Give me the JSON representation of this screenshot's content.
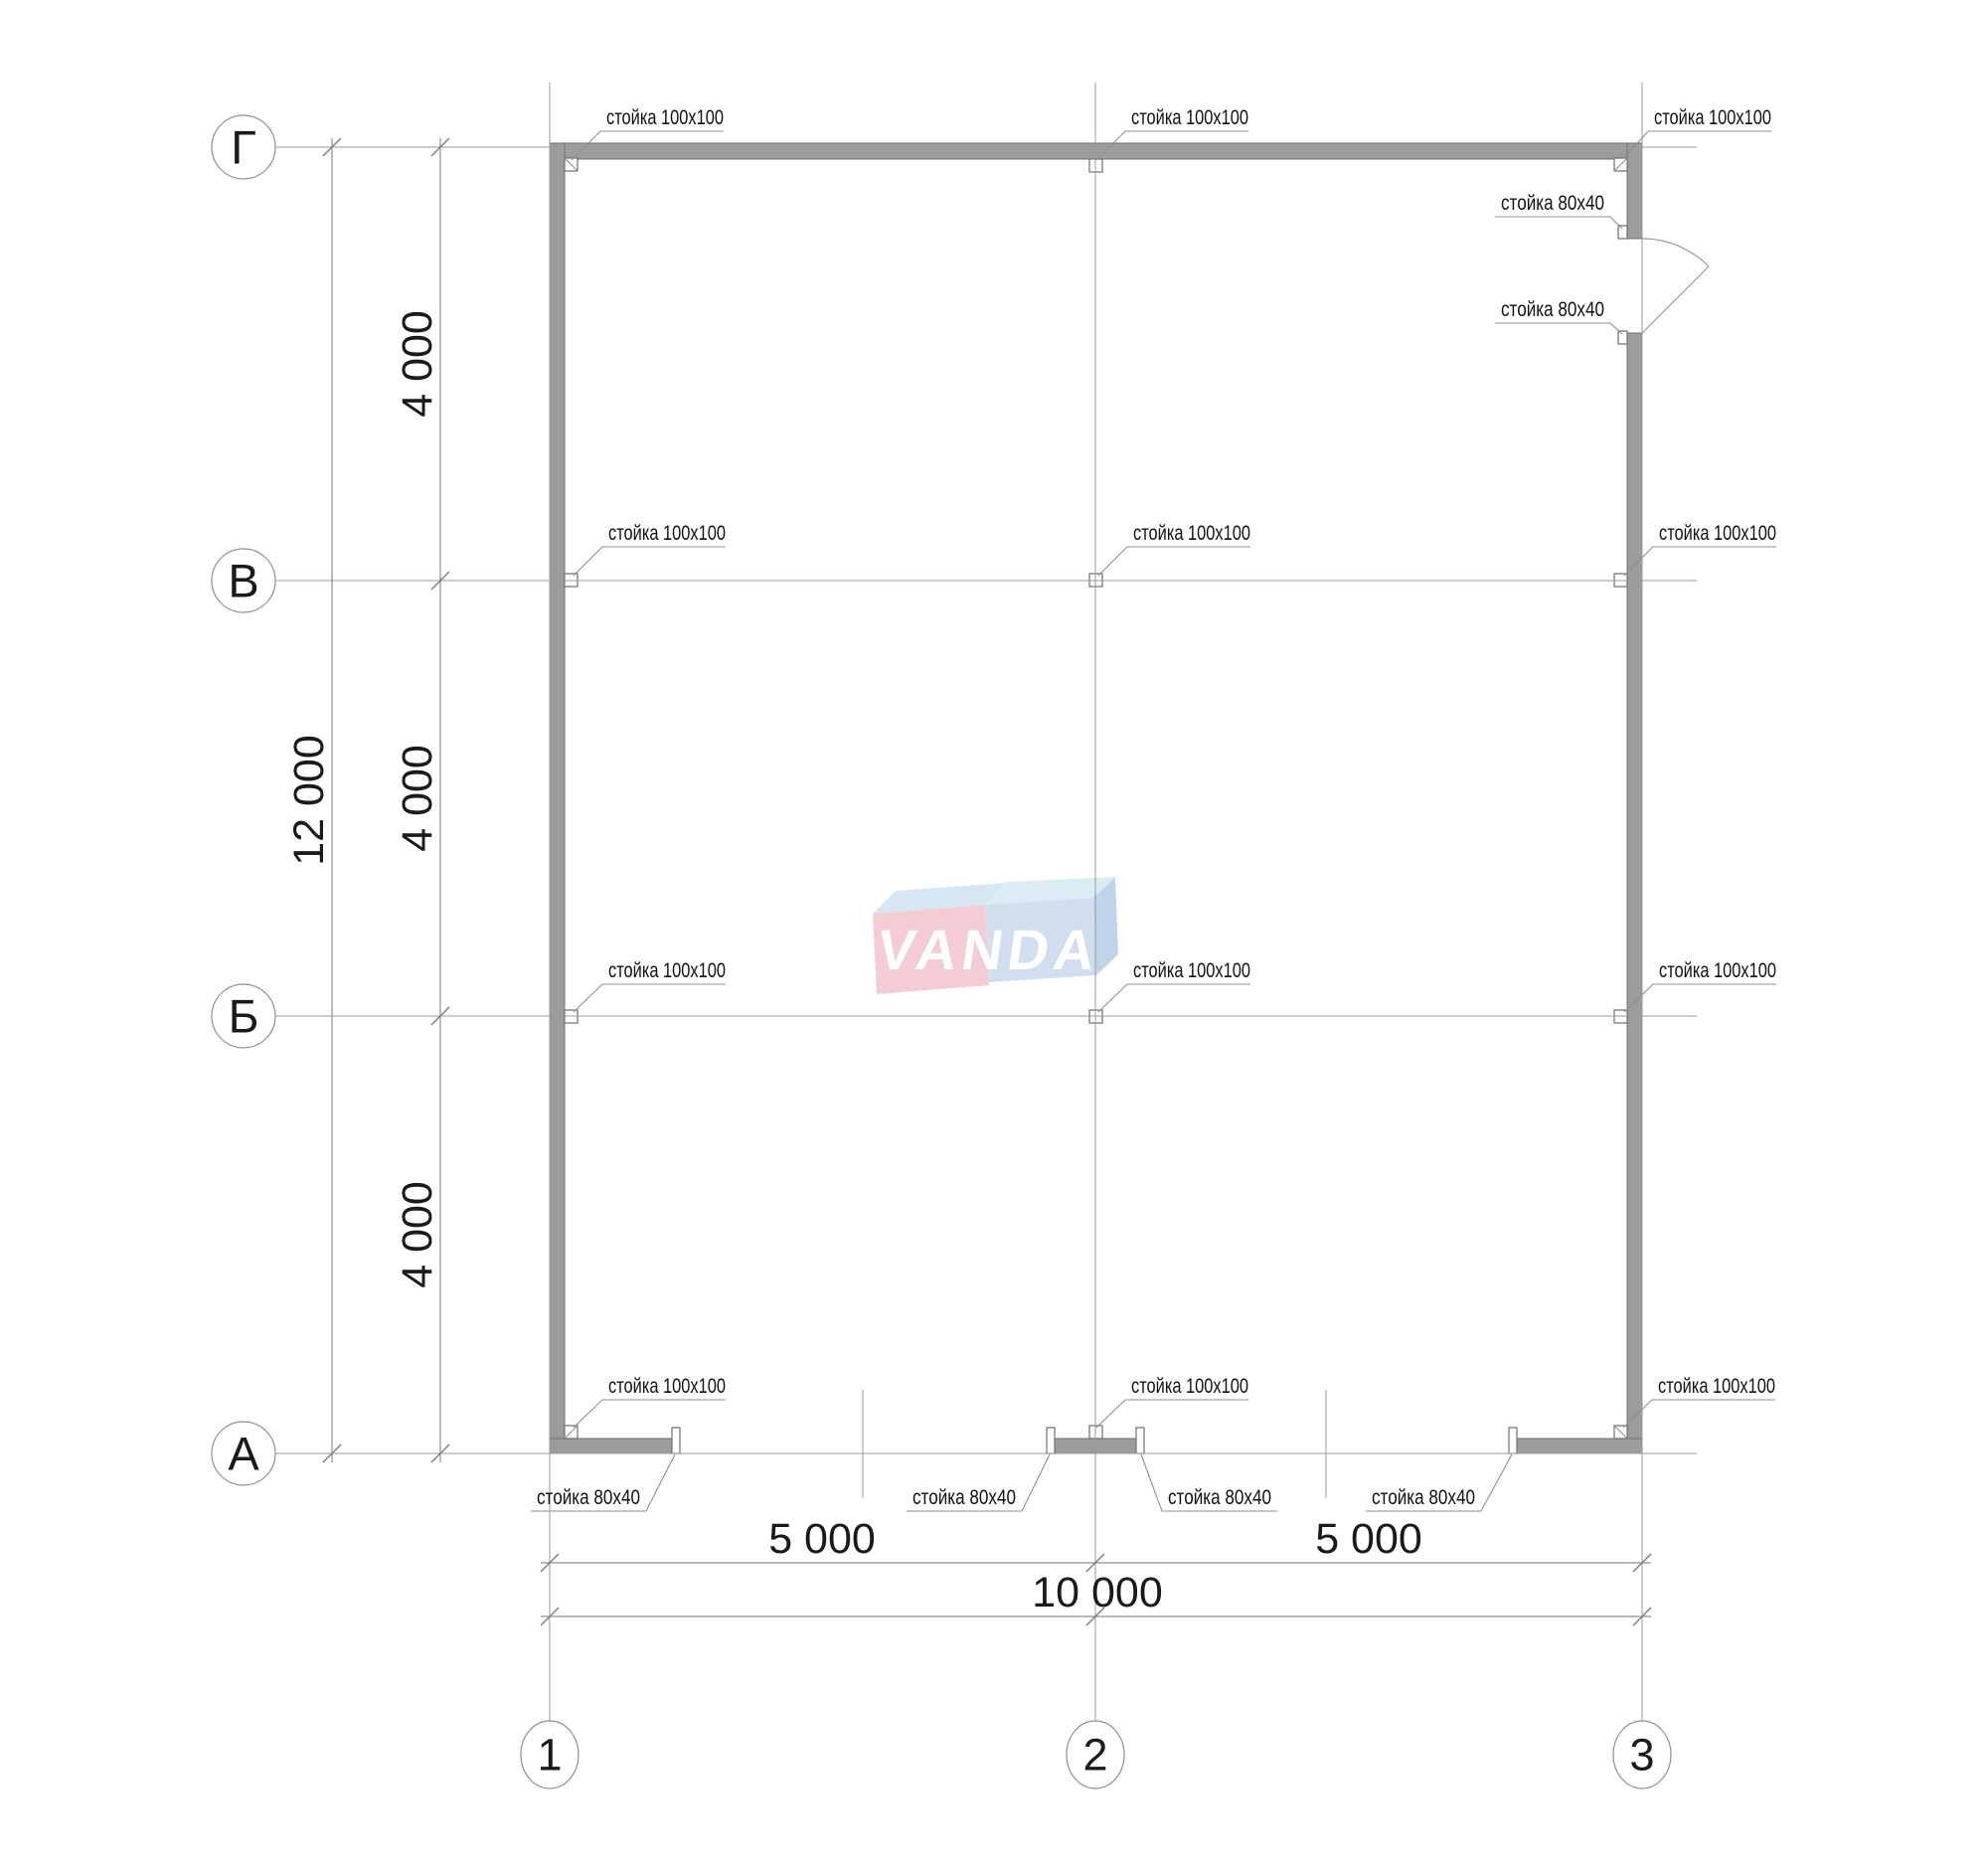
{
  "axis_grid": {
    "row_bubbles": {
      "r1": "Г",
      "r2": "В",
      "r3": "Б",
      "r4": "А"
    },
    "col_bubbles": {
      "c1": "1",
      "c2": "2",
      "c3": "3"
    }
  },
  "dimensions": {
    "vertical_overall": "12 000",
    "vertical_segment": "4 000",
    "horizontal_segment": "5 000",
    "horizontal_overall": "10 000"
  },
  "post_labels": {
    "post_100": "стойка 100x100",
    "post_80": "стойка 80x40"
  },
  "watermark": {
    "text": "VANDA",
    "pink_front": "#f3c7d0",
    "pink_top": "#d2e5f2",
    "blue_front": "#ccdbee",
    "blue_top": "#d9eaf6",
    "blue_side": "#b9cfe7",
    "letter_color": "#ffffff"
  },
  "colors": {
    "wall_fill": "#9c9c9c",
    "wall_stroke": "#6f6f6f",
    "line": "#9a9a9a",
    "text": "#1a1a1a"
  }
}
